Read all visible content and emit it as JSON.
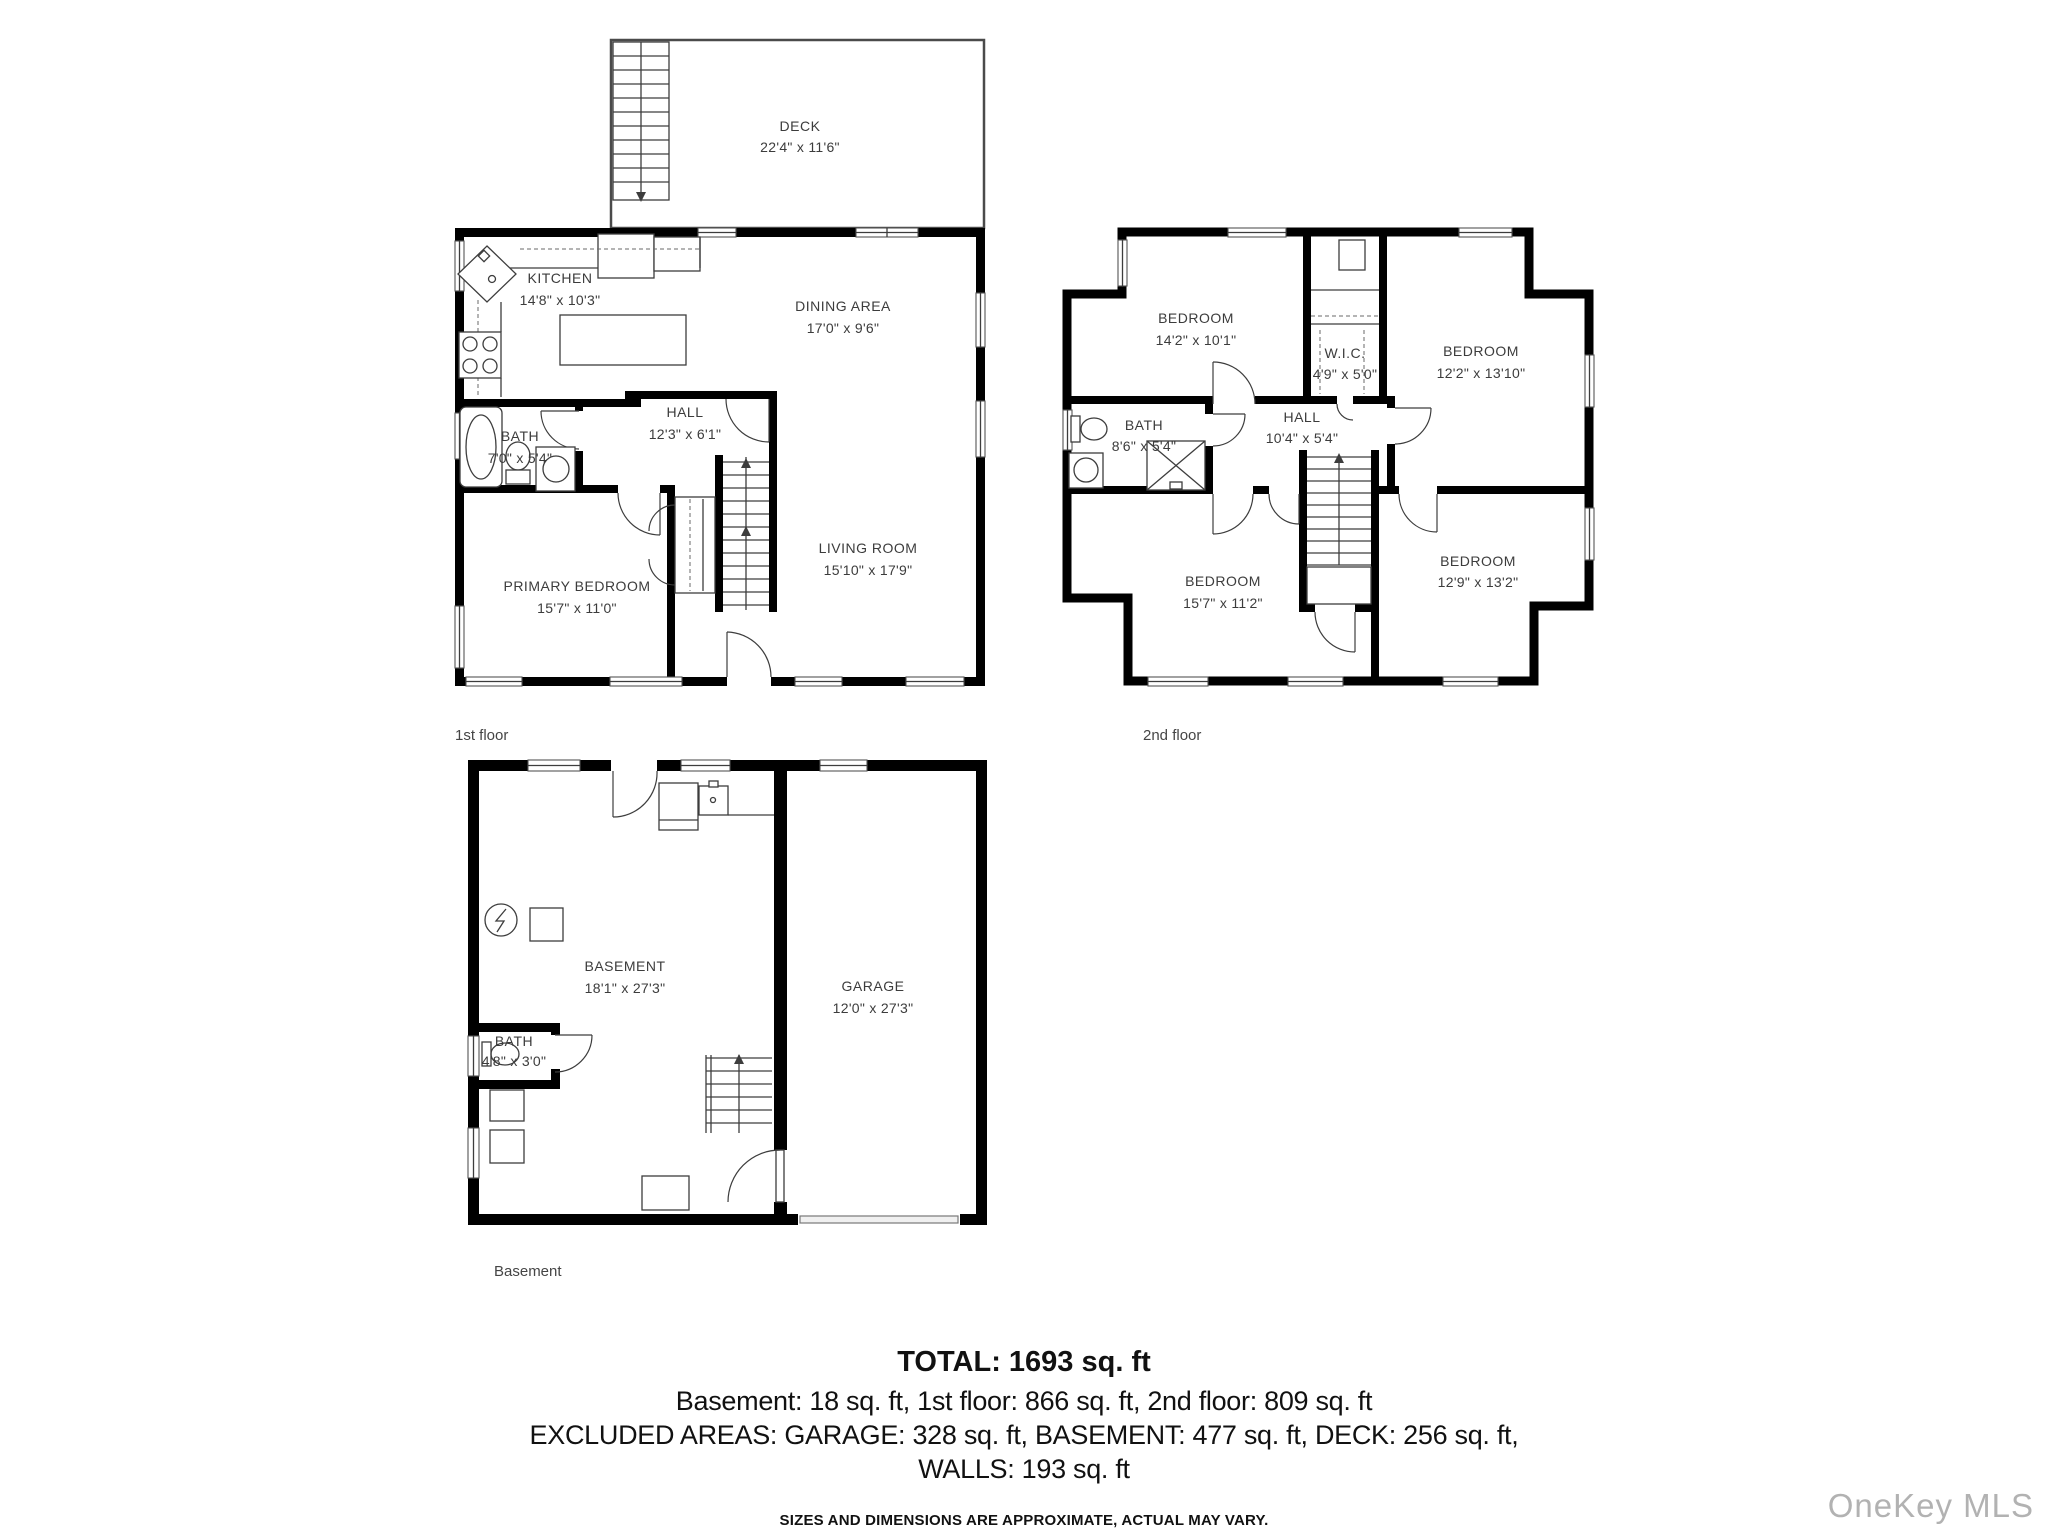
{
  "plans": {
    "first_floor": {
      "caption": "1st floor",
      "deck": {
        "name": "DECK",
        "dims": "22'4\" x 11'6\""
      },
      "kitchen": {
        "name": "KITCHEN",
        "dims": "14'8\" x 10'3\""
      },
      "dining": {
        "name": "DINING AREA",
        "dims": "17'0\" x 9'6\""
      },
      "hall": {
        "name": "HALL",
        "dims": "12'3\" x 6'1\""
      },
      "bath": {
        "name": "BATH",
        "dims": "7'0\" x 5'4\""
      },
      "living": {
        "name": "LIVING ROOM",
        "dims": "15'10\" x 17'9\""
      },
      "primary_bedroom": {
        "name": "PRIMARY BEDROOM",
        "dims": "15'7\" x 11'0\""
      }
    },
    "second_floor": {
      "caption": "2nd floor",
      "bedroom_top_left": {
        "name": "BEDROOM",
        "dims": "14'2\" x 10'1\""
      },
      "wic": {
        "name": "W.I.C.",
        "dims": "4'9\" x 5'0\""
      },
      "bedroom_top_right": {
        "name": "BEDROOM",
        "dims": "12'2\" x 13'10\""
      },
      "bath": {
        "name": "BATH",
        "dims": "8'6\" x 5'4\""
      },
      "hall": {
        "name": "HALL",
        "dims": "10'4\" x 5'4\""
      },
      "bedroom_bottom_left": {
        "name": "BEDROOM",
        "dims": "15'7\" x 11'2\""
      },
      "bedroom_bottom_right": {
        "name": "BEDROOM",
        "dims": "12'9\" x 13'2\""
      }
    },
    "basement": {
      "caption": "Basement",
      "basement": {
        "name": "BASEMENT",
        "dims": "18'1\" x 27'3\""
      },
      "garage": {
        "name": "GARAGE",
        "dims": "12'0\" x 27'3\""
      },
      "bath": {
        "name": "BATH",
        "dims": "4'8\" x 3'0\""
      }
    }
  },
  "summary": {
    "total": "TOTAL: 1693 sq. ft",
    "line1": "Basement: 18 sq. ft, 1st floor: 866 sq. ft, 2nd floor: 809 sq. ft",
    "line2": "EXCLUDED AREAS: GARAGE: 328 sq. ft, BASEMENT: 477 sq. ft, DECK: 256 sq. ft,",
    "line3": "WALLS: 193 sq. ft",
    "disclaimer": "SIZES AND DIMENSIONS ARE APPROXIMATE, ACTUAL MAY VARY."
  },
  "watermark": "OneKey MLS",
  "colors": {
    "wall": "#000000",
    "line": "#3d3d3d",
    "label": "#3c3c3c",
    "watermark": "#b2b2b2"
  }
}
